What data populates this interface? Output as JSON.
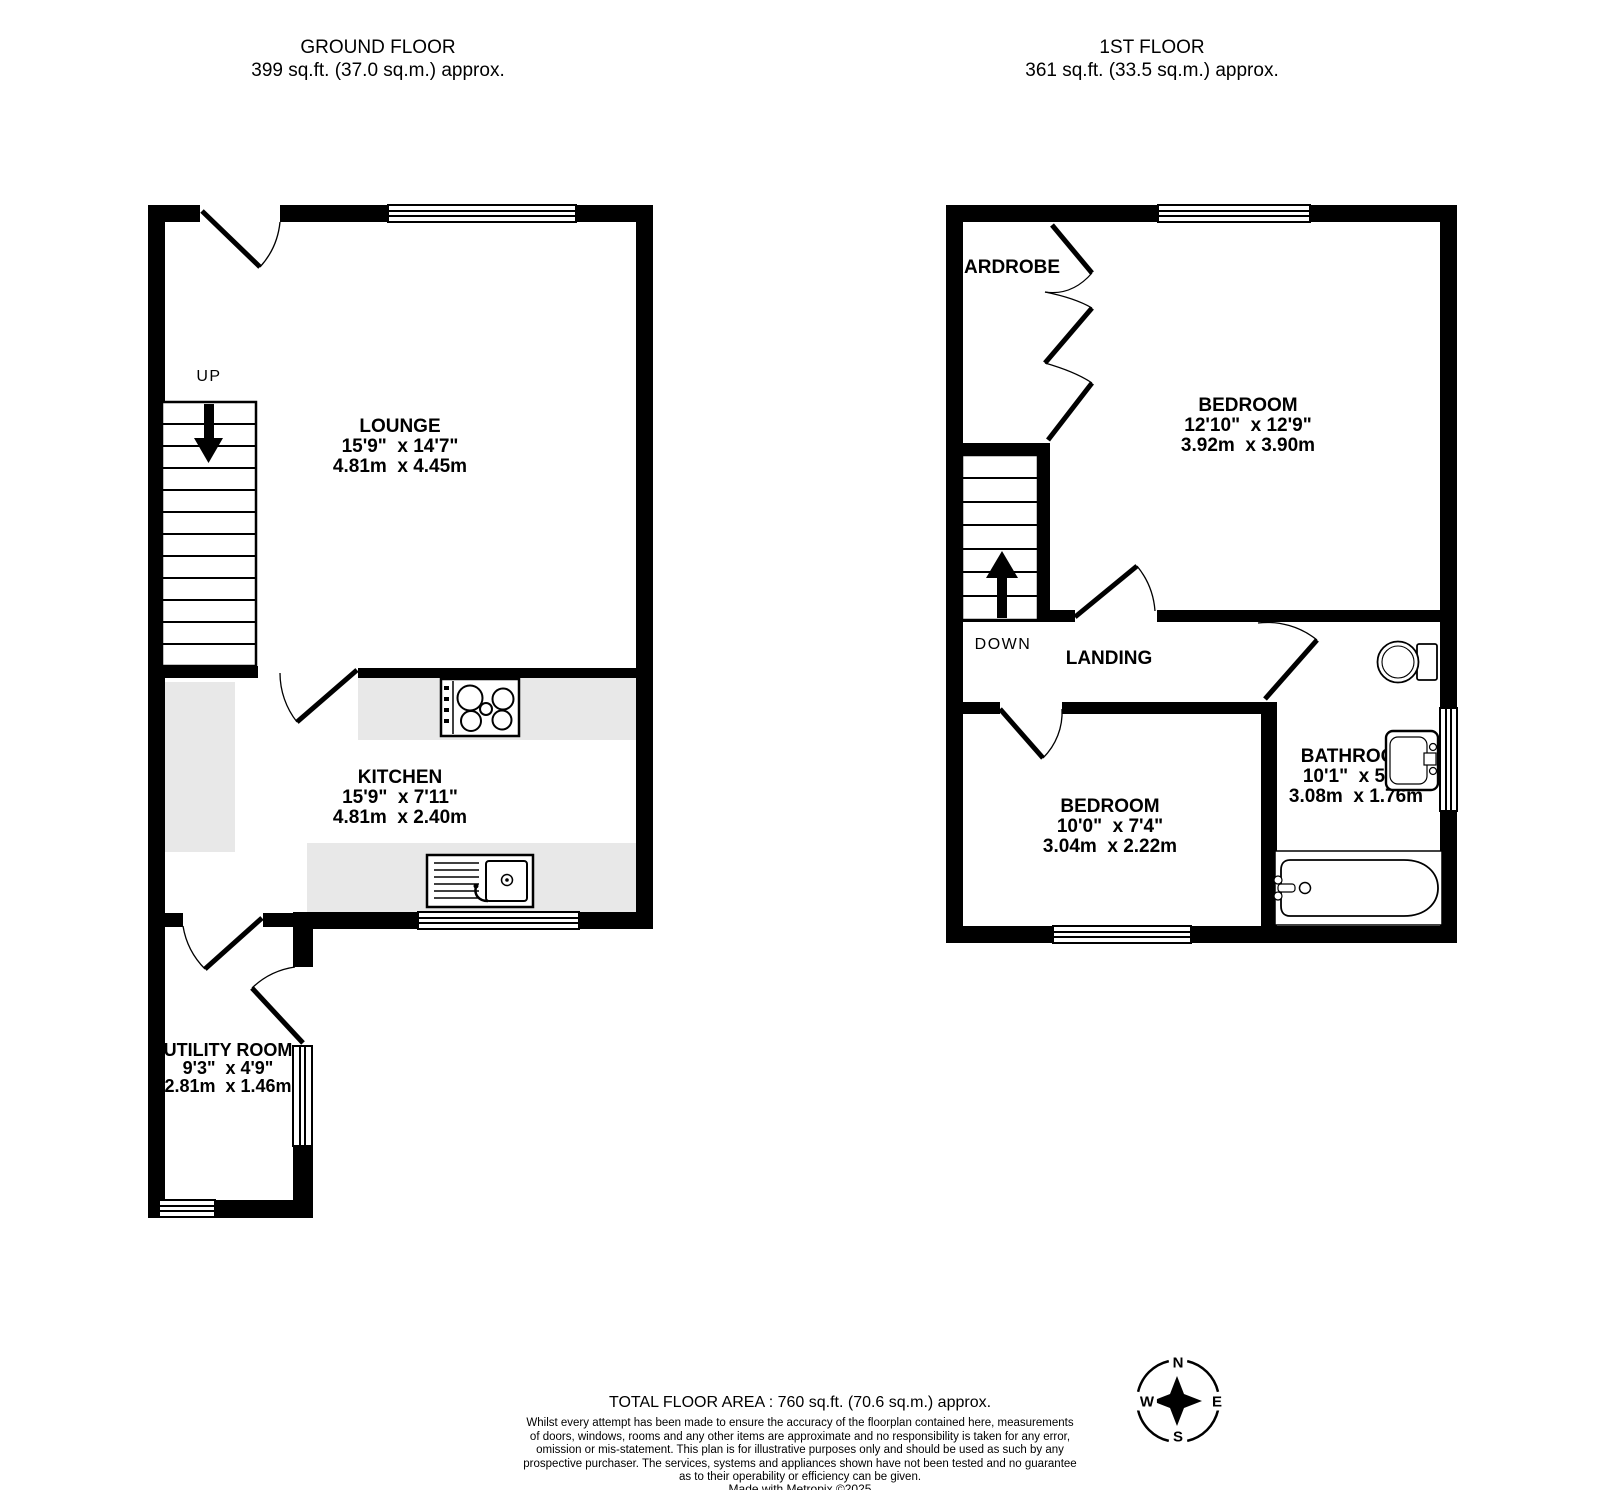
{
  "floors": {
    "ground": {
      "title": "GROUND FLOOR",
      "area": "399 sq.ft. (37.0 sq.m.) approx.",
      "stairs_label": "UP",
      "rooms": {
        "lounge": {
          "name": "LOUNGE",
          "imperial": "15'9\"  x 14'7\"",
          "metric": "4.81m  x 4.45m"
        },
        "kitchen": {
          "name": "KITCHEN",
          "imperial": "15'9\"  x 7'11\"",
          "metric": "4.81m  x 2.40m"
        },
        "utility": {
          "name": "UTILITY ROOM",
          "imperial": "9'3\"  x 4'9\"",
          "metric": "2.81m  x 1.46m"
        }
      }
    },
    "first": {
      "title": "1ST FLOOR",
      "area": "361 sq.ft. (33.5 sq.m.) approx.",
      "stairs_label": "DOWN",
      "rooms": {
        "bedroom1": {
          "name": "BEDROOM",
          "imperial": "12'10\"  x 12'9\"",
          "metric": "3.92m  x 3.90m"
        },
        "bedroom2": {
          "name": "BEDROOM",
          "imperial": "10'0\"  x 7'4\"",
          "metric": "3.04m  x 2.22m"
        },
        "bathroom": {
          "name": "BATHROOM",
          "imperial": "10'1\"  x 5'9\"",
          "metric": "3.08m  x 1.76m"
        },
        "landing": {
          "name": "LANDING"
        },
        "wardrobe": {
          "name": "ARDROBE"
        }
      }
    }
  },
  "compass": {
    "n": "N",
    "e": "E",
    "s": "S",
    "w": "W"
  },
  "footer": {
    "total": "TOTAL FLOOR AREA : 760 sq.ft. (70.6 sq.m.) approx.",
    "disclaimer": "Whilst every attempt has been made to ensure the accuracy of the floorplan contained here, measurements\nof doors, windows, rooms and any other items are approximate and no responsibility is taken for any error,\nomission or mis-statement. This plan is for illustrative purposes only and should be used as such by any\nprospective purchaser. The services, systems and appliances shown have not been tested and no guarantee\nas to their operability or efficiency can be given.",
    "credit": "Made with Metropix ©2025"
  },
  "colors": {
    "wall": "#000000",
    "counter": "#e8e8e8",
    "background": "#ffffff"
  }
}
